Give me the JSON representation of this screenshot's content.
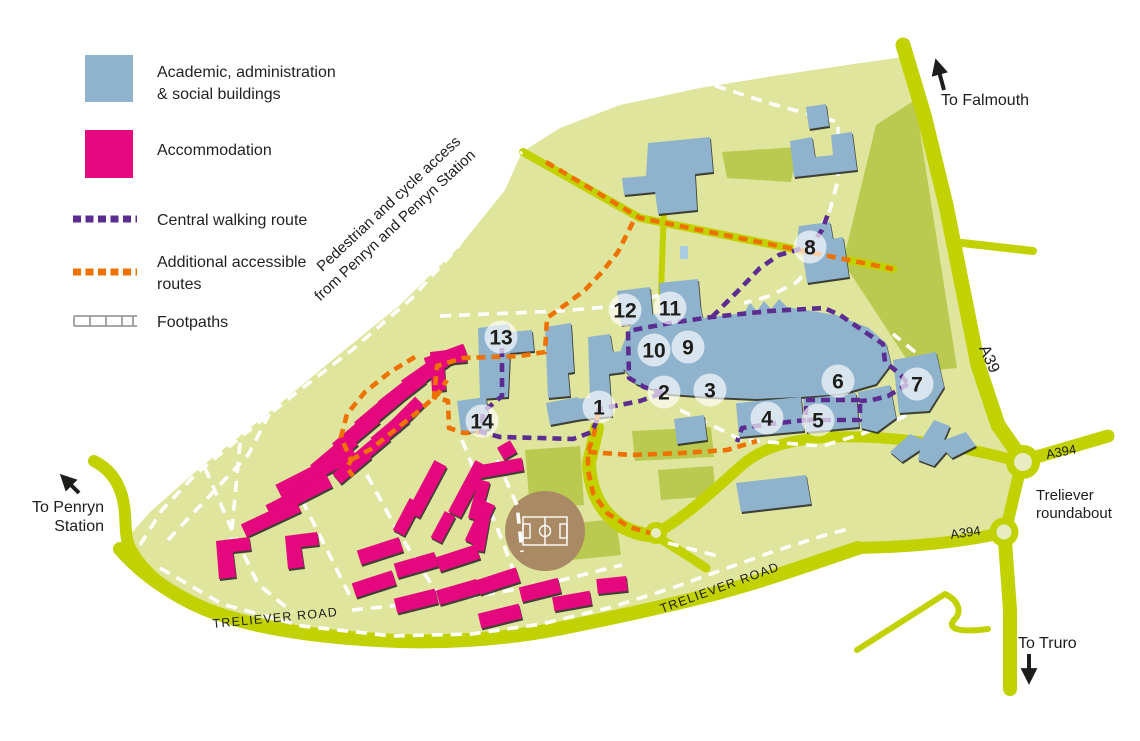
{
  "legend": {
    "items": [
      {
        "swatch": "academic-square",
        "line1": "Academic, administration",
        "line2": "& social buildings"
      },
      {
        "swatch": "accommodation-square",
        "line1": "Accommodation",
        "line2": ""
      },
      {
        "swatch": "central-route-dash",
        "line1": "Central walking route",
        "line2": ""
      },
      {
        "swatch": "accessible-route-dash",
        "line1": "Additional accessible",
        "line2": "routes"
      },
      {
        "swatch": "footpath-ladder",
        "line1": "Footpaths",
        "line2": ""
      }
    ]
  },
  "map": {
    "colors": {
      "academic": "#8fb3cd",
      "accommodation": "#e5077d",
      "central_route": "#5c2d91",
      "accessible_route": "#ee7202",
      "campus": "#dfe59c",
      "road": "#c2d100",
      "patch": "#bac94f",
      "pitch": "#a98a64",
      "footpath": "#ffffff"
    },
    "labels": {
      "to_falmouth": "To Falmouth",
      "a39": "A39",
      "a394_east": "A394",
      "a394_south": "A394",
      "treliever_rb_line1": "Treliever",
      "treliever_rb_line2": "roundabout",
      "to_truro": "To Truro",
      "to_penryn_line1": "To Penryn",
      "to_penryn_line2": "Station",
      "treliever_road_west": "TRELIEVER ROAD",
      "treliever_road_east": "TRELIEVER ROAD",
      "pedestrian_line1": "Pedestrian and cycle access",
      "pedestrian_line2": "from Penryn and Penryn Station"
    },
    "markers": [
      {
        "label": "1",
        "x": 599,
        "y": 407
      },
      {
        "label": "2",
        "x": 664,
        "y": 392
      },
      {
        "label": "3",
        "x": 710,
        "y": 390
      },
      {
        "label": "4",
        "x": 767,
        "y": 418
      },
      {
        "label": "5",
        "x": 818,
        "y": 420
      },
      {
        "label": "6",
        "x": 838,
        "y": 381
      },
      {
        "label": "7",
        "x": 917,
        "y": 384
      },
      {
        "label": "8",
        "x": 810,
        "y": 247
      },
      {
        "label": "9",
        "x": 688,
        "y": 347
      },
      {
        "label": "10",
        "x": 654,
        "y": 350
      },
      {
        "label": "11",
        "x": 670,
        "y": 308
      },
      {
        "label": "12",
        "x": 625,
        "y": 310
      },
      {
        "label": "13",
        "x": 501,
        "y": 337
      },
      {
        "label": "14",
        "x": 482,
        "y": 421
      }
    ]
  }
}
